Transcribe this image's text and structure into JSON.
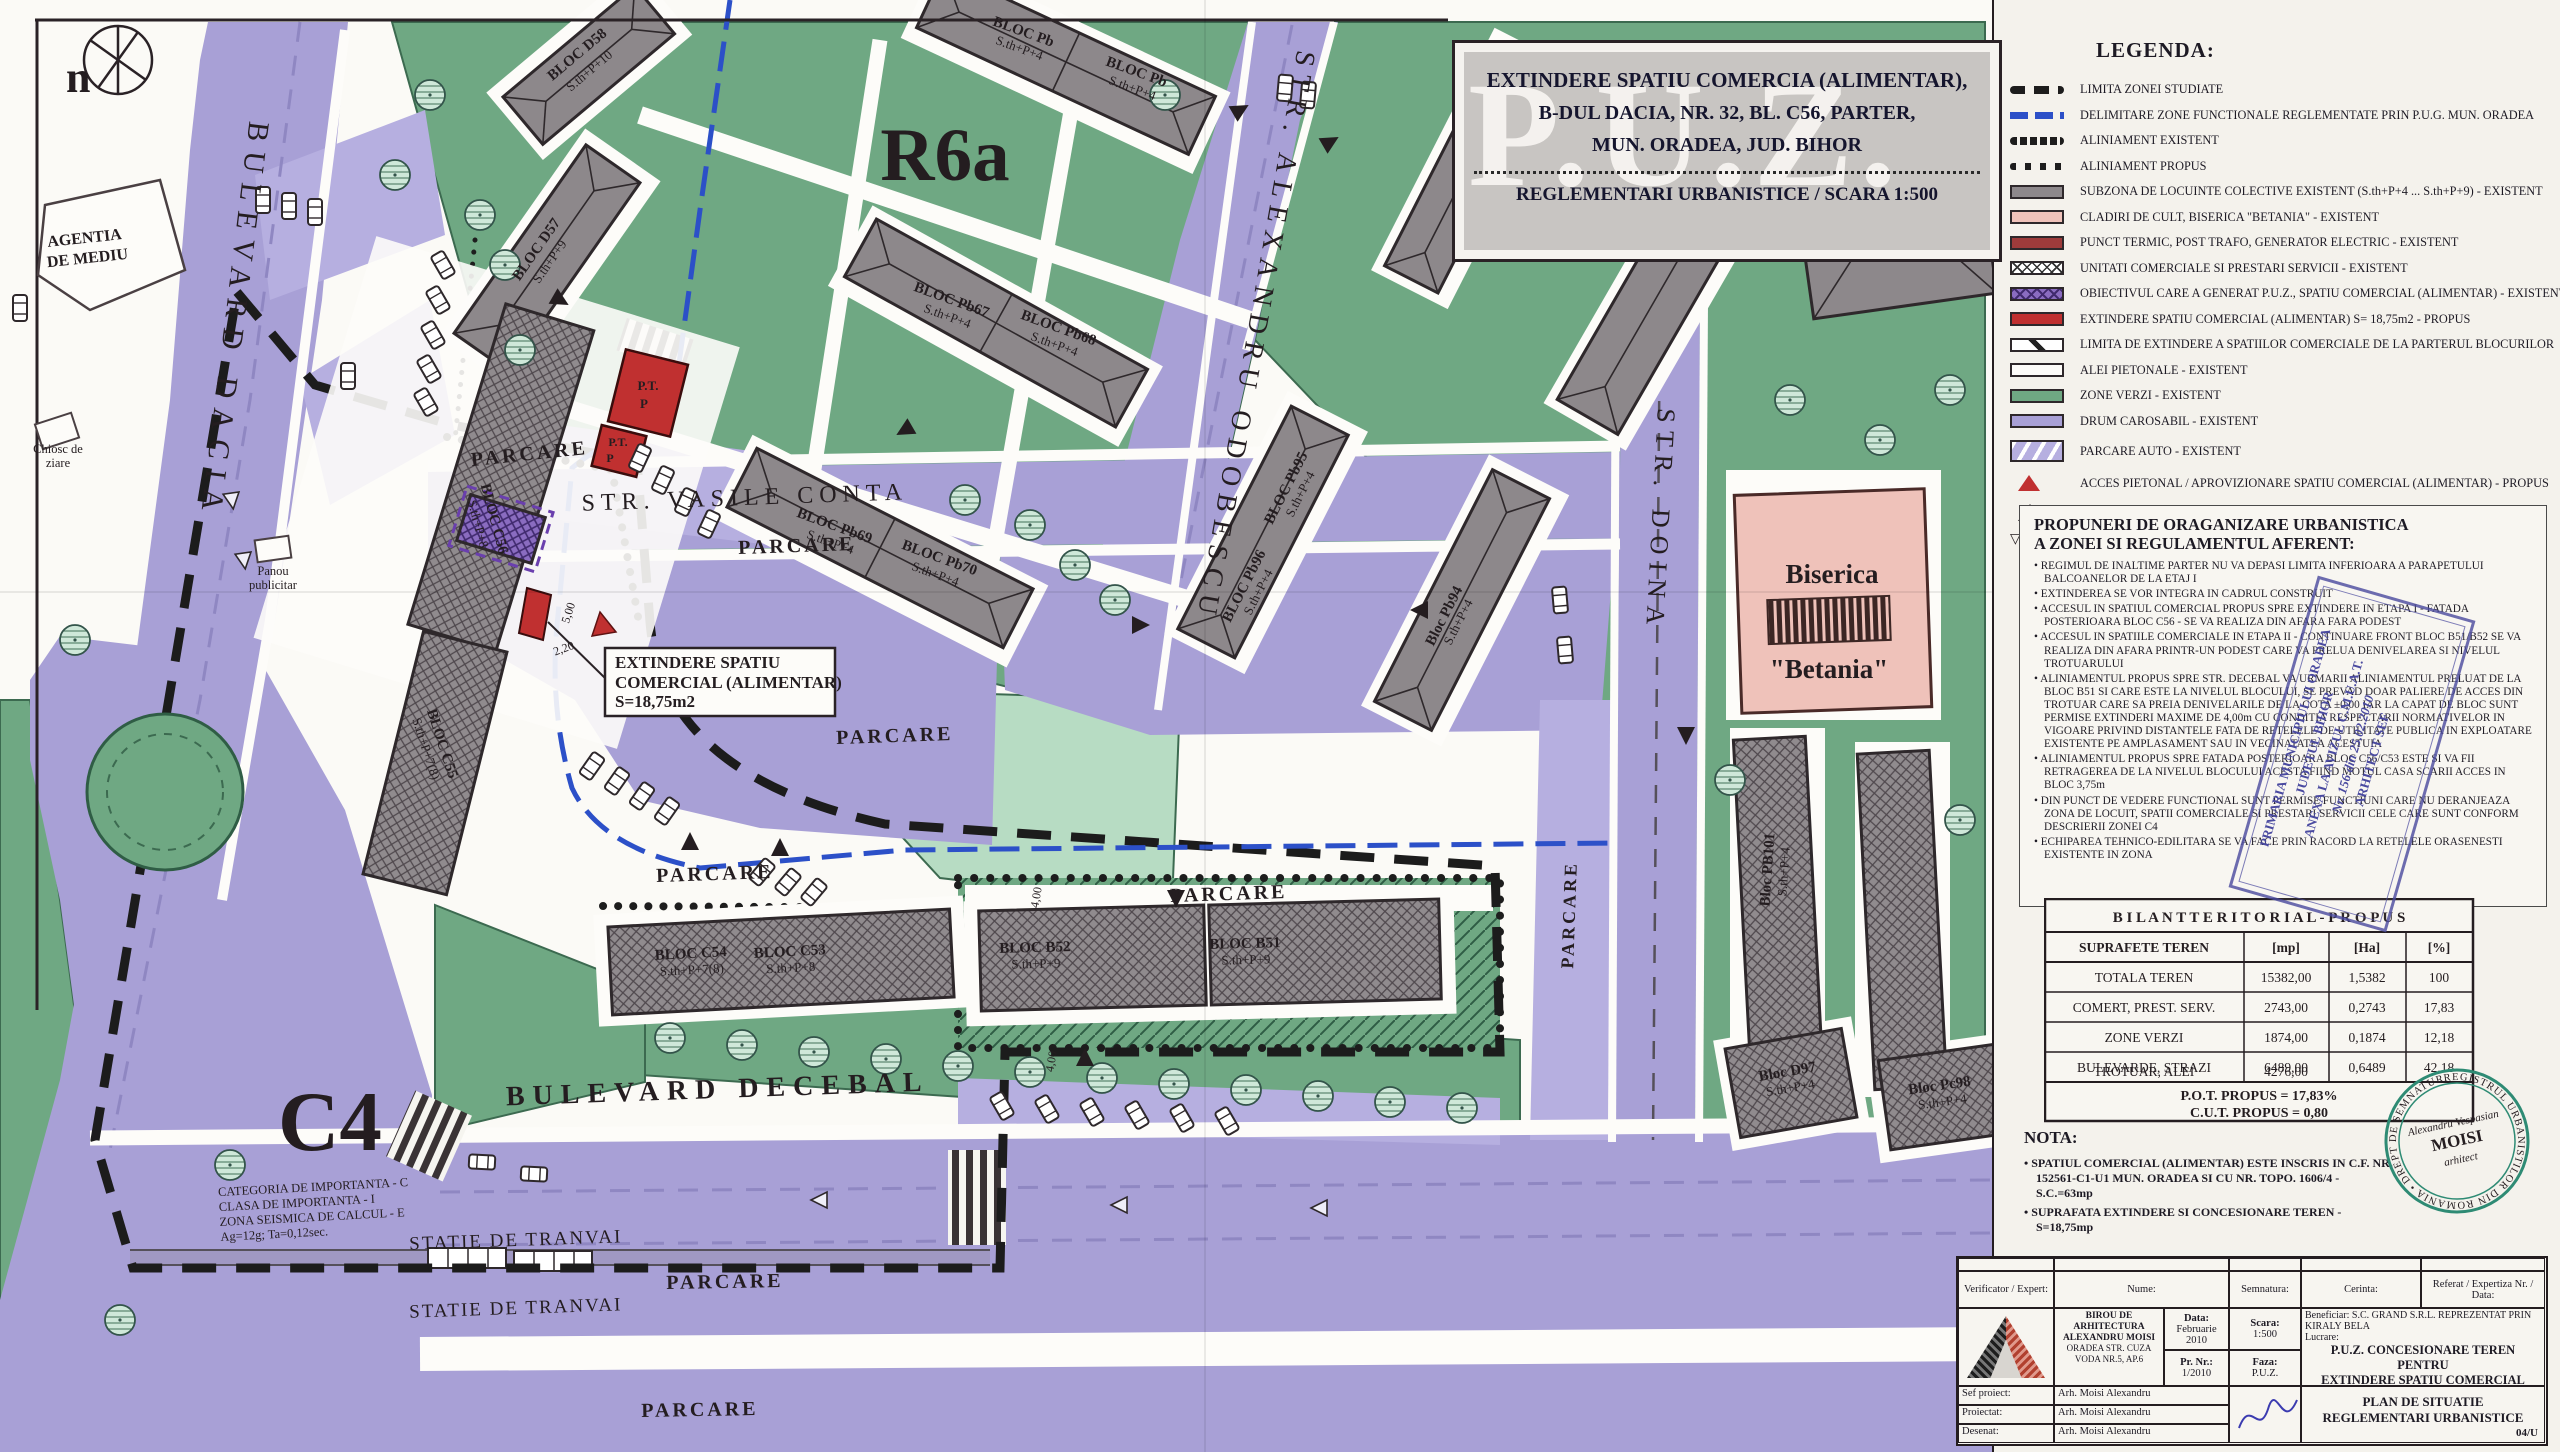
{
  "title_block": {
    "line1": "EXTINDERE SPATIU COMERCIA (ALIMENTAR),",
    "line2": "B-DUL DACIA, NR. 32, BL. C56, PARTER,",
    "line3": "MUN. ORADEA, JUD. BIHOR",
    "reg": "REGLEMENTARI URBANISTICE / SCARA 1:500",
    "watermark": "P.U.Z."
  },
  "legend": {
    "title": "LEGENDA:",
    "items": [
      {
        "label": "LIMITA ZONEI STUDIATE"
      },
      {
        "label": "DELIMITARE ZONE FUNCTIONALE REGLEMENTATE PRIN P.U.G. MUN. ORADEA"
      },
      {
        "label": "ALINIAMENT EXISTENT"
      },
      {
        "label": "ALINIAMENT PROPUS"
      },
      {
        "label": "SUBZONA DE LOCUINTE COLECTIVE EXISTENT (S.th+P+4 ... S.th+P+9) - EXISTENT"
      },
      {
        "label": "CLADIRI DE CULT, BISERICA \"BETANIA\" - EXISTENT"
      },
      {
        "label": "PUNCT TERMIC, POST TRAFO, GENERATOR ELECTRIC - EXISTENT"
      },
      {
        "label": "UNITATI COMERCIALE SI PRESTARI SERVICII - EXISTENT"
      },
      {
        "label": "OBIECTIVUL CARE A GENERAT P.U.Z., SPATIU COMERCIAL (ALIMENTAR) - EXISTENT"
      },
      {
        "label": "EXTINDERE SPATIU COMERCIAL (ALIMENTAR) S= 18,75m2 - PROPUS"
      },
      {
        "label": "LIMITA DE EXTINDERE A SPATIILOR COMERCIALE DE LA PARTERUL BLOCURILOR"
      },
      {
        "label": "ALEI PIETONALE - EXISTENT"
      },
      {
        "label": "ZONE VERZI - EXISTENT"
      },
      {
        "label": "DRUM CAROSABIL - EXISTENT"
      },
      {
        "label": "PARCARE AUTO - EXISTENT"
      },
      {
        "label": "ACCES PIETONAL / APROVIZIONARE SPATIU COMERCIAL (ALIMENTAR) - PROPUS"
      },
      {
        "label": "ACCES PIETONAL - EXISTENT"
      },
      {
        "label": "SENS DE CICULATIE - EXISTENT",
        "glyph": "▽▽ △"
      }
    ]
  },
  "proposals": {
    "heading_line1": "PROPUNERI DE ORAGANIZARE URBANISTICA",
    "heading_line2": "A ZONEI SI REGULAMENTUL AFERENT:",
    "items": [
      "REGIMUL DE INALTIME PARTER NU VA DEPASI LIMITA INFERIOARA A PARAPETULUI BALCOANELOR DE LA ETAJ I",
      "EXTINDEREA SE VOR INTEGRA IN CADRUL CONSTRUIT",
      "ACCESUL IN SPATIUL COMERCIAL PROPUS SPRE EXTINDERE IN ETAPA I - FATADA POSTERIOARA BLOC C56 - SE VA REALIZA DIN AFARA FARA PODEST",
      "ACCESUL IN SPATIILE COMERCIALE IN ETAPA II - CONTINUARE FRONT BLOC B51/B52 SE VA REALIZA DIN AFARA PRINTR-UN PODEST CARE VA PRELUA DENIVELAREA SI NIVELUL TROTUARULUI",
      "ALINIAMENTUL PROPUS SPRE STR. DECEBAL VA URMARII ALINIAMENTUL PRELUAT DE LA BLOC B51 SI CARE ESTE LA NIVELUL BLOCULUI, SE PREVAD DOAR PALIERE DE ACCES DIN TROTUAR CARE SA PREIA DENIVELARILE DE LA COTA ±0,00 IAR LA CAPAT DE BLOC SUNT PERMISE EXTINDERI MAXIME DE 4,00m CU CONDITIA RESPECTARII NORMATIVELOR IN VIGOARE PRIVIND DISTANTELE FATA DE RETELELE DE UTILITATE PUBLICA IN EXPLOATARE EXISTENTE PE AMPLASAMENT SAU IN VECINATATEA ACESTUIA",
      "ALINIAMENTUL PROPUS SPRE FATADA POSTERIOARA BLOC C56/C53 ESTE SI VA FII RETRAGEREA DE LA NIVELUL BLOCULUI ACESTA FIIND MOTUL CASA SCARII ACCES IN BLOC 3,75m",
      "DIN PUNCT DE VEDERE FUNCTIONAL SUNT PERMISE FUNCTIUNI CARE NU DERANJEAZA ZONA DE LOCUIT, SPATII COMERCIALE SI PRESTARI SERVICII CELE CARE SUNT CONFORM DESCRIERII ZONEI C4",
      "ECHIPAREA TEHNICO-EDILITARA SE VA FACE PRIN RACORD LA RETELELE ORASENESTI EXISTENTE IN ZONA"
    ]
  },
  "stamp_primaria": {
    "line1": "PRIMARIA MUNICIPIULUI ORADEA",
    "line2": "JUDETUL BIHOR",
    "line3": "ANEXA LA AVIZUL C.M.U.A.T.",
    "line4": "Nr. 156 din 25.02.2010",
    "line5": "ARHITECT SEF"
  },
  "stamp_rur": {
    "ring": "REGISTRUL URBANISTILOR DIN ROMANIA • DREPT DE SEMNATURA •",
    "center1": "Alexandru Vespasian",
    "center2": "MOISI",
    "center3": "arhitect"
  },
  "bilant": {
    "title": "B I L A N T   T E R I T O R I A L - P R O P U S",
    "headers": [
      "SUPRAFETE TEREN",
      "[mp]",
      "[Ha]",
      "[%]"
    ],
    "rows": [
      [
        "TOTALA TEREN",
        "15382,00",
        "1,5382",
        "100"
      ],
      [
        "COMERT, PREST. SERV.",
        "2743,00",
        "0,2743",
        "17,83"
      ],
      [
        "ZONE VERZI",
        "1874,00",
        "0,1874",
        "12,18"
      ],
      [
        "BULEVARDE, STRAZI",
        "6489,00",
        "0,6489",
        "42,18"
      ],
      [
        "TROTUAR, ALEI",
        "4276,00",
        "0,4276",
        "27,81"
      ]
    ],
    "footer1": "P.O.T. PROPUS = 17,83%",
    "footer2": "C.U.T. PROPUS  = 0,80"
  },
  "nota": {
    "title": "NOTA:",
    "items": [
      "SPATIUL COMERCIAL (ALIMENTAR) ESTE INSCRIS IN C.F. NR. 152561-C1-U1 MUN. ORADEA SI CU NR. TOPO. 1606/4 - S.C.=63mp",
      "SUPRAFATA EXTINDERE SI CONCESIONARE TEREN - S=18,75mp"
    ]
  },
  "cartouche": {
    "verificator_label": "Verificator / Expert:",
    "nume_label": "Nume:",
    "semnatura_label": "Semnatura:",
    "cerinta_label": "Cerinta:",
    "referat_label": "Referat /  Expertiza Nr. / Data:",
    "firm_line1": "BIROU DE ARHITECTURA ALEXANDRU MOISI",
    "firm_line2": "ORADEA STR. CUZA VODA NR.5, AP.6",
    "data_label": "Data:",
    "data_value": "Februarie 2010",
    "scara_label": "Scara:",
    "scara_value": "1:500",
    "prnr_label": "Pr. Nr.:",
    "prnr_value": "1/2010",
    "faza_label": "Faza:",
    "faza_value": "P.U.Z.",
    "beneficiar": "Beneficiar: S.C. GRAND S.R.L. REPREZENTAT PRIN KIRALY BELA",
    "lucrare_label": "Lucrare:",
    "lucrare_line1": "P.U.Z. CONCESIONARE TEREN PENTRU",
    "lucrare_line2": "EXTINDERE SPATIU COMERCIAL (ALIMENTAR),",
    "lucrare_line3": "B-DUL DACIA, NR. 32, BL. C56 - PARTER,",
    "lucrare_line4": "MUN. ORADEA, JUD. BIHOR",
    "sef_label": "Sef proiect:",
    "sef_value": "Arh. Moisi Alexandru",
    "proiectat_label": "Proiectat:",
    "proiectat_value": "Arh. Moisi Alexandru",
    "desenat_label": "Desenat:",
    "desenat_value": "Arh. Moisi Alexandru",
    "plansa_line1": "PLAN DE SITUATIE",
    "plansa_line2": "REGLEMENTARI URBANISTICE",
    "plansa_nr": "04/U"
  },
  "map": {
    "zone_labels": {
      "r6a": "R6a",
      "c4": "C4"
    },
    "streets": {
      "dacia": "BULEVARD DACIA",
      "odobescu": "STR. ALEXANDRU ODOBESCU",
      "doina": "STR. DOINA",
      "conta": "STR. VASILE CONTA",
      "decebal": "BULEVARD DECEBAL"
    },
    "parcare": "PARCARE",
    "tram_stop": "STATIE DE TRANVAI",
    "callout": {
      "line1": "EXTINDERE SPATIU",
      "line2": "COMERCIAL (ALIMENTAR)",
      "line3": "S=18,75m2"
    },
    "poi": {
      "north": "n",
      "agentia1": "AGENTIA",
      "agentia2": "DE MEDIU",
      "chiosc1": "Chiosc de",
      "chiosc2": "ziare",
      "panou1": "Panou",
      "panou2": "publicitar",
      "biserica1": "Biserica",
      "biserica2": "\"Betania\"",
      "pt": "P.T.",
      "p": "P"
    },
    "importanta": [
      "CATEGORIA DE IMPORTANTA - C",
      "CLASA DE IMPORTANTA - I",
      "ZONA SEISMICA DE CALCUL - E",
      "Ag=12g; Ta=0,12sec."
    ],
    "dims": {
      "d500": "5,00",
      "d220": "2,20",
      "d400": "4,00"
    },
    "blocks": [
      {
        "name": "BLOC D58",
        "floors": "S.th+P+10"
      },
      {
        "name": "BLOC D57",
        "floors": "S.th+P+9"
      },
      {
        "name": "BLOC Pb",
        "floors": "S.th+P+4"
      },
      {
        "name": "BLOC Pb",
        "floors": "S.th+P+4"
      },
      {
        "name": "BLOC Pb67",
        "floors": "S.th+P+4"
      },
      {
        "name": "BLOC Pb68",
        "floors": "S.th+P+4"
      },
      {
        "name": "BLOC Pb69",
        "floors": "S.th+P+4"
      },
      {
        "name": "BLOC Pb70",
        "floors": "S.th+P+4"
      },
      {
        "name": "BLOC C56",
        "floors": "S.th+P+8"
      },
      {
        "name": "BLOC C55",
        "floors": "S.th+P+7(8)"
      },
      {
        "name": "BLOC C54",
        "floors": "S.th+P+7(8)"
      },
      {
        "name": "BLOC C53",
        "floors": "S.th+P+8"
      },
      {
        "name": "BLOC B52",
        "floors": "S.th+P+9"
      },
      {
        "name": "BLOC B51",
        "floors": "S.th+P+9"
      },
      {
        "name": "BLOC Pb95",
        "floors": "S.th+P+4"
      },
      {
        "name": "BLOC Pb96",
        "floors": "S.th+P+4"
      },
      {
        "name": "Bloc Pb94",
        "floors": "S.th+P+4"
      },
      {
        "name": "Bloc PB101",
        "floors": "S.th+P+4"
      },
      {
        "name": "Bloc D97",
        "floors": "S.th+P+4"
      },
      {
        "name": "Bloc Pc98",
        "floors": "S.th+P+4"
      }
    ]
  }
}
